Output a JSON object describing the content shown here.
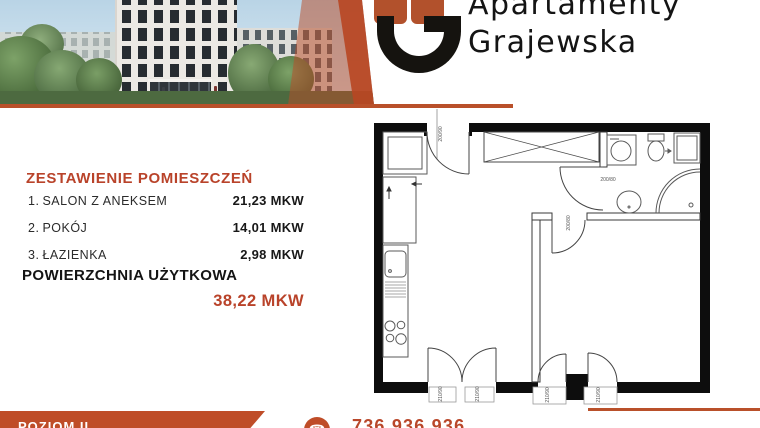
{
  "brand": {
    "line1": "Apartamenty",
    "line2": "Grajewska"
  },
  "summary": {
    "title": "ZESTAWIENIE POMIESZCZEŃ",
    "rooms": [
      {
        "no": "1.",
        "name": "SALON Z ANEKSEM",
        "area": "21,23 MKW"
      },
      {
        "no": "2.",
        "name": "POKÓJ",
        "area": "14,01 MKW"
      },
      {
        "no": "3.",
        "name": "ŁAZIENKA",
        "area": "2,98 MKW"
      }
    ],
    "total_label": "POWIERZCHNIA UŻYTKOWA",
    "total_value": "38,22 MKW"
  },
  "footer": {
    "level": "POZIOM II",
    "phone": "736 936 936"
  },
  "icons": {
    "phone": "☎"
  },
  "floor_plan": {
    "labels": {
      "entrance_door": "200/90",
      "bathroom_door": "200/80",
      "room_door": "200/80",
      "sill": "210/90"
    }
  },
  "colors": {
    "accent": "#b9432a",
    "banner": "#bf4d28",
    "logo_square": "#b2512c",
    "wall": "#0d0d0d"
  }
}
